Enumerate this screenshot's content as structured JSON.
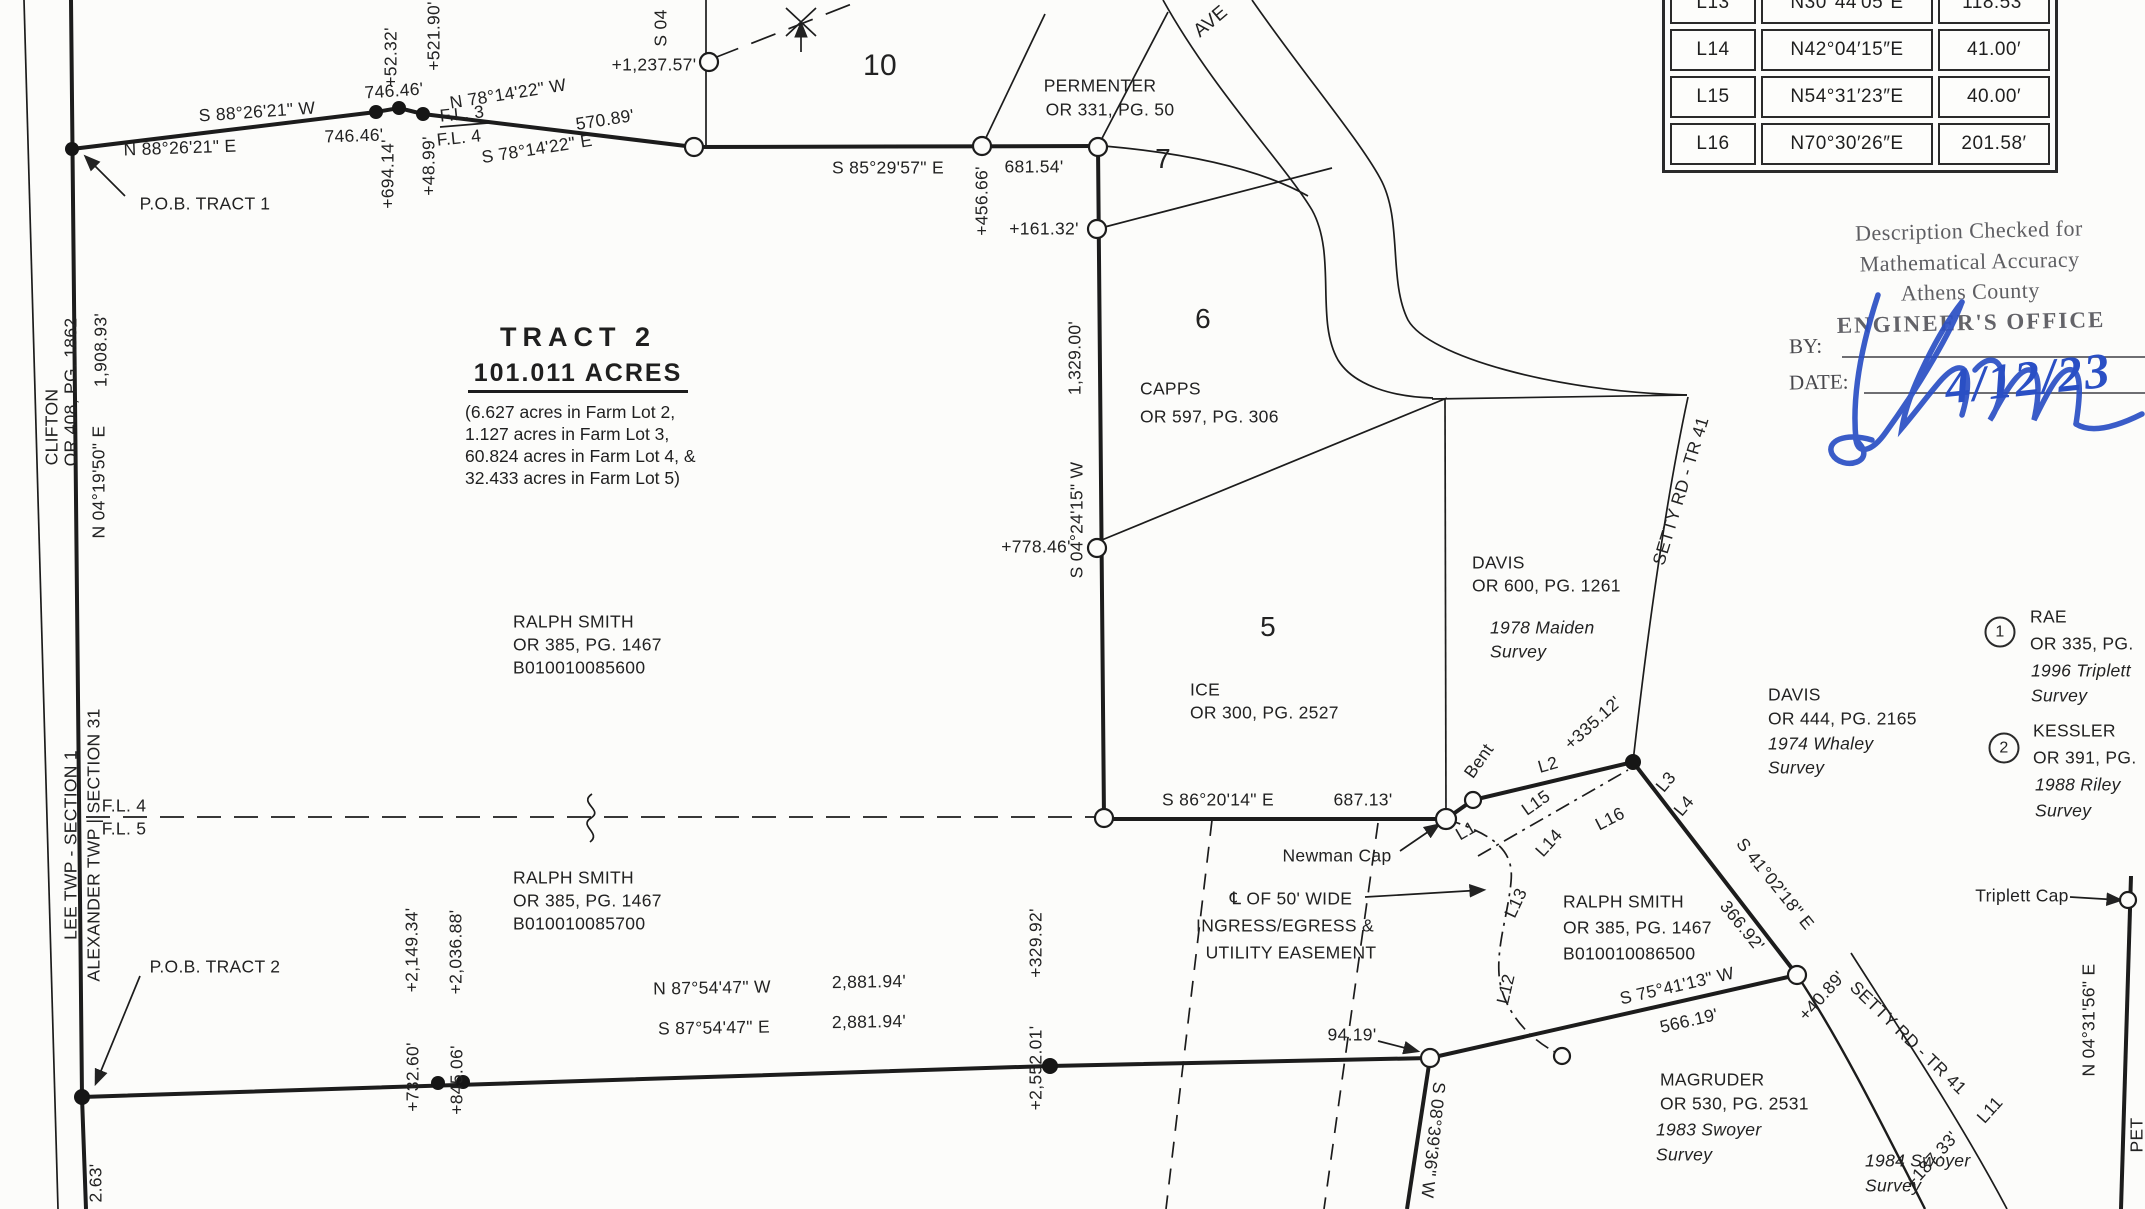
{
  "colors": {
    "ink": "#1f1f1f",
    "stamp_gray": "#49494e",
    "signature_blue": "#2a4fc4",
    "paper": "#fcfcfa"
  },
  "tract_note": {
    "title": "TRACT 2",
    "acreage": "101.011 ACRES",
    "details": [
      "(6.627 acres in Farm Lot 2,",
      "1.127 acres in Farm Lot 3,",
      "60.824 acres in Farm Lot 4, &",
      "32.433 acres in Farm Lot 5)"
    ]
  },
  "line_table": {
    "rows": [
      {
        "id": "L13",
        "bearing": "N30°44′05″E",
        "distance": "118.53′"
      },
      {
        "id": "L14",
        "bearing": "N42°04′15″E",
        "distance": "41.00′"
      },
      {
        "id": "L15",
        "bearing": "N54°31′23″E",
        "distance": "40.00′"
      },
      {
        "id": "L16",
        "bearing": "N70°30′26″E",
        "distance": "201.58′"
      }
    ]
  },
  "stamp": {
    "lines": [
      "Description Checked for",
      "Mathematical Accuracy",
      "Athens County",
      "ENGINEER'S OFFICE"
    ],
    "by_label": "BY:",
    "date_label": "DATE:",
    "date_value": "4/12/23"
  },
  "labels": [
    {
      "n": "bearing-s882621w",
      "t": "S 88°26'21\" W",
      "x": 257,
      "y": 112,
      "r": -4
    },
    {
      "n": "dist-74646-above",
      "t": "746.46'",
      "x": 394,
      "y": 91,
      "r": -4
    },
    {
      "n": "bearing-n882621e",
      "t": "N 88°26'21\" E",
      "x": 180,
      "y": 148,
      "r": -2
    },
    {
      "n": "dist-74646-below",
      "t": "746.46'",
      "x": 354,
      "y": 136,
      "r": -2
    },
    {
      "n": "pob-tract-1",
      "t": "P.O.B. TRACT 1",
      "x": 205,
      "y": 204
    },
    {
      "n": "tick-5232",
      "t": "+52.32'",
      "x": 391,
      "y": 57,
      "r": -90
    },
    {
      "n": "tick-52190",
      "t": "+521.90'",
      "x": 434,
      "y": 36,
      "r": -90
    },
    {
      "n": "tick-69414",
      "t": "+694.14'",
      "x": 388,
      "y": 174,
      "r": -90
    },
    {
      "n": "tick-4899",
      "t": "+48.99'",
      "x": 429,
      "y": 166,
      "r": -90
    },
    {
      "n": "farm-lot-line-3",
      "t": "F.L. 3",
      "x": 462,
      "y": 114,
      "r": -6
    },
    {
      "n": "farm-lot-line-4",
      "t": "F.L. 4",
      "x": 459,
      "y": 138,
      "r": -6
    },
    {
      "n": "bearing-n781422w",
      "t": "N 78°14'22\" W",
      "x": 508,
      "y": 94,
      "r": -9
    },
    {
      "n": "dist-57089",
      "t": "570.89'",
      "x": 605,
      "y": 120,
      "r": -9
    },
    {
      "n": "bearing-s781422e",
      "t": "S 78°14'22\" E",
      "x": 537,
      "y": 149,
      "r": -9
    },
    {
      "n": "bearing-s04-partial",
      "t": "S 04",
      "x": 661,
      "y": 28,
      "r": -90
    },
    {
      "n": "tick-123757",
      "t": "+1,237.57'",
      "x": 654,
      "y": 65
    },
    {
      "n": "farm-lot-10",
      "t": "10",
      "x": 880,
      "y": 66,
      "s": 30
    },
    {
      "n": "owner-permenter",
      "t": "PERMENTER",
      "x": 1100,
      "y": 86
    },
    {
      "n": "owner-permenter-ref",
      "t": "OR 331, PG. 50",
      "x": 1110,
      "y": 110
    },
    {
      "n": "road-ave-partial",
      "t": "AVE",
      "x": 1211,
      "y": 22,
      "r": -40,
      "s": 19
    },
    {
      "n": "bearing-s852957e",
      "t": "S 85°29'57\" E",
      "x": 888,
      "y": 168
    },
    {
      "n": "dist-68154",
      "t": "681.54'",
      "x": 1034,
      "y": 167
    },
    {
      "n": "tick-45666",
      "t": "+456.66'",
      "x": 982,
      "y": 201,
      "r": -90
    },
    {
      "n": "farm-lot-7",
      "t": "7",
      "x": 1163,
      "y": 159,
      "s": 28
    },
    {
      "n": "tick-16132",
      "t": "+161.32'",
      "x": 1044,
      "y": 229
    },
    {
      "n": "dist-132900",
      "t": "1,329.00'",
      "x": 1075,
      "y": 358,
      "r": -90
    },
    {
      "n": "bearing-s042415w",
      "t": "S 04°24'15\" W",
      "x": 1077,
      "y": 520,
      "r": -90
    },
    {
      "n": "tick-77846",
      "t": "+778.46'",
      "x": 1036,
      "y": 547
    },
    {
      "n": "owner-capps",
      "t": "CAPPS",
      "x": 1140,
      "y": 389,
      "a": "l"
    },
    {
      "n": "owner-capps-ref",
      "t": "OR 597, PG. 306",
      "x": 1140,
      "y": 417,
      "a": "l"
    },
    {
      "n": "farm-lot-6",
      "t": "6",
      "x": 1203,
      "y": 319,
      "s": 28
    },
    {
      "n": "owner-clifton",
      "t": "CLIFTON",
      "x": 52,
      "y": 427,
      "r": -90
    },
    {
      "n": "owner-clifton-ref",
      "t": "OR 408, PG. 1862",
      "x": 71,
      "y": 392,
      "r": -90
    },
    {
      "n": "dist-190893",
      "t": "1,908.93'",
      "x": 101,
      "y": 350,
      "r": -90
    },
    {
      "n": "bearing-n041950e",
      "t": "N 04°19'50\" E",
      "x": 99,
      "y": 482,
      "r": -90
    },
    {
      "n": "twp-lee-section1",
      "t": "LEE TWP - SECTION 1",
      "x": 71,
      "y": 845,
      "r": -90
    },
    {
      "n": "twp-alexander-section31",
      "t": "ALEXANDER TWP | SECTION 31",
      "x": 94,
      "y": 845,
      "r": -90
    },
    {
      "n": "dist-263-partial",
      "t": "2.63'",
      "x": 96,
      "y": 1183,
      "r": -90
    },
    {
      "n": "owner-ralph-smith-1",
      "t": "RALPH SMITH",
      "x": 513,
      "y": 622,
      "a": "l"
    },
    {
      "n": "owner-ralph-smith-1-ref",
      "t": "OR 385, PG. 1467",
      "x": 513,
      "y": 645,
      "a": "l"
    },
    {
      "n": "owner-ralph-smith-1-parcel",
      "t": "B010010085600",
      "x": 513,
      "y": 668,
      "a": "l"
    },
    {
      "n": "farm-lot-line-4b",
      "t": "F.L. 4",
      "x": 124,
      "y": 806
    },
    {
      "n": "farm-lot-line-5",
      "t": "F.L. 5",
      "x": 124,
      "y": 829
    },
    {
      "n": "owner-ice",
      "t": "ICE",
      "x": 1190,
      "y": 690,
      "a": "l"
    },
    {
      "n": "owner-ice-ref",
      "t": "OR 300, PG. 2527",
      "x": 1190,
      "y": 713,
      "a": "l"
    },
    {
      "n": "farm-lot-5",
      "t": "5",
      "x": 1268,
      "y": 627,
      "s": 28
    },
    {
      "n": "owner-davis-600",
      "t": "DAVIS",
      "x": 1472,
      "y": 563,
      "a": "l"
    },
    {
      "n": "owner-davis-600-ref",
      "t": "OR 600, PG. 1261",
      "x": 1472,
      "y": 586,
      "a": "l"
    },
    {
      "n": "survey-maiden-1978a",
      "t": "1978 Maiden",
      "x": 1490,
      "y": 628,
      "a": "l",
      "i": 1
    },
    {
      "n": "survey-maiden-1978b",
      "t": "Survey",
      "x": 1490,
      "y": 652,
      "a": "l",
      "i": 1
    },
    {
      "n": "road-setty-upper",
      "t": "SETTY RD - TR 41",
      "x": 1681,
      "y": 491,
      "r": -73
    },
    {
      "n": "owner-davis-444",
      "t": "DAVIS",
      "x": 1768,
      "y": 695,
      "a": "l"
    },
    {
      "n": "owner-davis-444-ref",
      "t": "OR 444, PG. 2165",
      "x": 1768,
      "y": 719,
      "a": "l"
    },
    {
      "n": "survey-whaley-1974a",
      "t": "1974 Whaley",
      "x": 1768,
      "y": 744,
      "a": "l",
      "i": 1
    },
    {
      "n": "survey-whaley-1974b",
      "t": "Survey",
      "x": 1768,
      "y": 768,
      "a": "l",
      "i": 1
    },
    {
      "n": "owner-rae",
      "t": "RAE",
      "x": 2030,
      "y": 617,
      "a": "l"
    },
    {
      "n": "owner-rae-ref",
      "t": "OR 335, PG.",
      "x": 2030,
      "y": 644,
      "a": "l"
    },
    {
      "n": "survey-triplett-1996a",
      "t": "1996 Triplett",
      "x": 2031,
      "y": 671,
      "a": "l",
      "i": 1
    },
    {
      "n": "survey-triplett-1996b",
      "t": "Survey",
      "x": 2031,
      "y": 696,
      "a": "l",
      "i": 1
    },
    {
      "n": "ref-marker-1",
      "t": "1",
      "x": 2000,
      "y": 632,
      "c": 1
    },
    {
      "n": "owner-kessler",
      "t": "KESSLER",
      "x": 2033,
      "y": 731,
      "a": "l"
    },
    {
      "n": "owner-kessler-ref",
      "t": "OR 391, PG.",
      "x": 2033,
      "y": 758,
      "a": "l"
    },
    {
      "n": "survey-riley-1988a",
      "t": "1988 Riley",
      "x": 2035,
      "y": 785,
      "a": "l",
      "i": 1
    },
    {
      "n": "survey-riley-1988b",
      "t": "Survey",
      "x": 2035,
      "y": 811,
      "a": "l",
      "i": 1
    },
    {
      "n": "ref-marker-2",
      "t": "2",
      "x": 2004,
      "y": 748,
      "c": 1
    },
    {
      "n": "bearing-s862014e",
      "t": "S 86°20'14\" E",
      "x": 1218,
      "y": 800
    },
    {
      "n": "dist-68713",
      "t": "687.13'",
      "x": 1363,
      "y": 800
    },
    {
      "n": "note-bent",
      "t": "Bent",
      "x": 1479,
      "y": 761,
      "r": -55
    },
    {
      "n": "seg-l1",
      "t": "L1",
      "x": 1466,
      "y": 831,
      "r": -30
    },
    {
      "n": "note-newman-cap",
      "t": "Newman Cap",
      "x": 1337,
      "y": 856
    },
    {
      "n": "easement-line-1",
      "t": "℄ OF 50' WIDE",
      "x": 1291,
      "y": 899
    },
    {
      "n": "easement-line-2",
      "t": "INGRESS/EGRESS &",
      "x": 1285,
      "y": 926
    },
    {
      "n": "easement-line-3",
      "t": "UTILITY EASEMENT",
      "x": 1291,
      "y": 953
    },
    {
      "n": "seg-l2",
      "t": "L2",
      "x": 1548,
      "y": 765,
      "r": -16
    },
    {
      "n": "seg-l15",
      "t": "L15",
      "x": 1536,
      "y": 803,
      "r": -35
    },
    {
      "n": "seg-l14",
      "t": "L14",
      "x": 1549,
      "y": 843,
      "r": -48
    },
    {
      "n": "seg-l16",
      "t": "L16",
      "x": 1610,
      "y": 819,
      "r": -27
    },
    {
      "n": "seg-l13",
      "t": "L13",
      "x": 1516,
      "y": 903,
      "r": -65
    },
    {
      "n": "seg-l12",
      "t": "L12",
      "x": 1506,
      "y": 989,
      "r": -77
    },
    {
      "n": "tick-33512",
      "t": "+335.12'",
      "x": 1593,
      "y": 723,
      "r": -42
    },
    {
      "n": "seg-l3",
      "t": "L3",
      "x": 1666,
      "y": 782,
      "r": -50
    },
    {
      "n": "seg-l4",
      "t": "L4",
      "x": 1684,
      "y": 806,
      "r": -50
    },
    {
      "n": "bearing-s410218e",
      "t": "S 41°02'18\" E",
      "x": 1775,
      "y": 884,
      "r": 51
    },
    {
      "n": "dist-36692",
      "t": "366.92'",
      "x": 1742,
      "y": 926,
      "r": 51
    },
    {
      "n": "owner-ralph-smith-2",
      "t": "RALPH SMITH",
      "x": 1563,
      "y": 902,
      "a": "l"
    },
    {
      "n": "owner-ralph-smith-2-ref",
      "t": "OR 385, PG. 1467",
      "x": 1563,
      "y": 928,
      "a": "l"
    },
    {
      "n": "owner-ralph-smith-2-parcel",
      "t": "B010010086500",
      "x": 1563,
      "y": 954,
      "a": "l"
    },
    {
      "n": "pob-tract-2",
      "t": "P.O.B. TRACT 2",
      "x": 215,
      "y": 967
    },
    {
      "n": "tick-214934",
      "t": "+2,149.34'",
      "x": 412,
      "y": 950,
      "r": -90
    },
    {
      "n": "tick-203688",
      "t": "+2,036.88'",
      "x": 456,
      "y": 952,
      "r": -90
    },
    {
      "n": "tick-73260",
      "t": "+732.60'",
      "x": 413,
      "y": 1077,
      "r": -90
    },
    {
      "n": "tick-84506",
      "t": "+845.06'",
      "x": 457,
      "y": 1080,
      "r": -90
    },
    {
      "n": "owner-ralph-smith-3",
      "t": "RALPH SMITH",
      "x": 513,
      "y": 878,
      "a": "l"
    },
    {
      "n": "owner-ralph-smith-3-ref",
      "t": "OR 385, PG. 1467",
      "x": 513,
      "y": 901,
      "a": "l"
    },
    {
      "n": "owner-ralph-smith-3-parcel",
      "t": "B010010085700",
      "x": 513,
      "y": 924,
      "a": "l"
    },
    {
      "n": "bearing-n875447w",
      "t": "N 87°54'47\" W",
      "x": 712,
      "y": 988,
      "r": -1
    },
    {
      "n": "dist-288194-above",
      "t": "2,881.94'",
      "x": 869,
      "y": 982,
      "r": -1
    },
    {
      "n": "bearing-s875447e",
      "t": "S 87°54'47\" E",
      "x": 714,
      "y": 1028,
      "r": -1
    },
    {
      "n": "dist-288194-below",
      "t": "2,881.94'",
      "x": 869,
      "y": 1022,
      "r": -1
    },
    {
      "n": "tick-32992",
      "t": "+329.92'",
      "x": 1036,
      "y": 943,
      "r": -90
    },
    {
      "n": "tick-255201",
      "t": "+2,552.01'",
      "x": 1036,
      "y": 1068,
      "r": -90
    },
    {
      "n": "dist-9419",
      "t": "94.19'",
      "x": 1352,
      "y": 1035
    },
    {
      "n": "bearing-s083936w",
      "t": "S 08°39'36\" W",
      "x": 1433,
      "y": 1140,
      "r": 96
    },
    {
      "n": "owner-magruder",
      "t": "MAGRUDER",
      "x": 1660,
      "y": 1080,
      "a": "l"
    },
    {
      "n": "owner-magruder-ref",
      "t": "OR 530, PG. 2531",
      "x": 1660,
      "y": 1104,
      "a": "l"
    },
    {
      "n": "survey-swoyer-1983a",
      "t": "1983 Swoyer",
      "x": 1656,
      "y": 1130,
      "a": "l",
      "i": 1
    },
    {
      "n": "survey-swoyer-1983b",
      "t": "Survey",
      "x": 1656,
      "y": 1155,
      "a": "l",
      "i": 1
    },
    {
      "n": "survey-swoyer-1984a",
      "t": "1984 Swoyer",
      "x": 1865,
      "y": 1161,
      "a": "l",
      "i": 1
    },
    {
      "n": "survey-swoyer-1984b",
      "t": "Survey",
      "x": 1865,
      "y": 1186,
      "a": "l",
      "i": 1
    },
    {
      "n": "bearing-s754113w",
      "t": "S 75°41'13\" W",
      "x": 1677,
      "y": 986,
      "r": -13
    },
    {
      "n": "dist-56619",
      "t": "566.19'",
      "x": 1689,
      "y": 1021,
      "r": -13
    },
    {
      "n": "road-setty-lower",
      "t": "SETTY RD - TR 41",
      "x": 1908,
      "y": 1038,
      "r": 44
    },
    {
      "n": "tick-4089",
      "t": "+40.89'",
      "x": 1822,
      "y": 996,
      "r": -48
    },
    {
      "n": "note-triplett-cap",
      "t": "Triplett Cap",
      "x": 2022,
      "y": 896
    },
    {
      "n": "bearing-n043156e",
      "t": "N 04°31'56\" E",
      "x": 2089,
      "y": 1020,
      "r": -90
    },
    {
      "n": "seg-l11",
      "t": "L11",
      "x": 1990,
      "y": 1110,
      "r": -48
    },
    {
      "n": "tick-18733",
      "t": "+187.33'",
      "x": 1932,
      "y": 1160,
      "r": -48
    },
    {
      "n": "edge-text-partial",
      "t": "PET",
      "x": 2137,
      "y": 1135,
      "r": -90
    }
  ]
}
